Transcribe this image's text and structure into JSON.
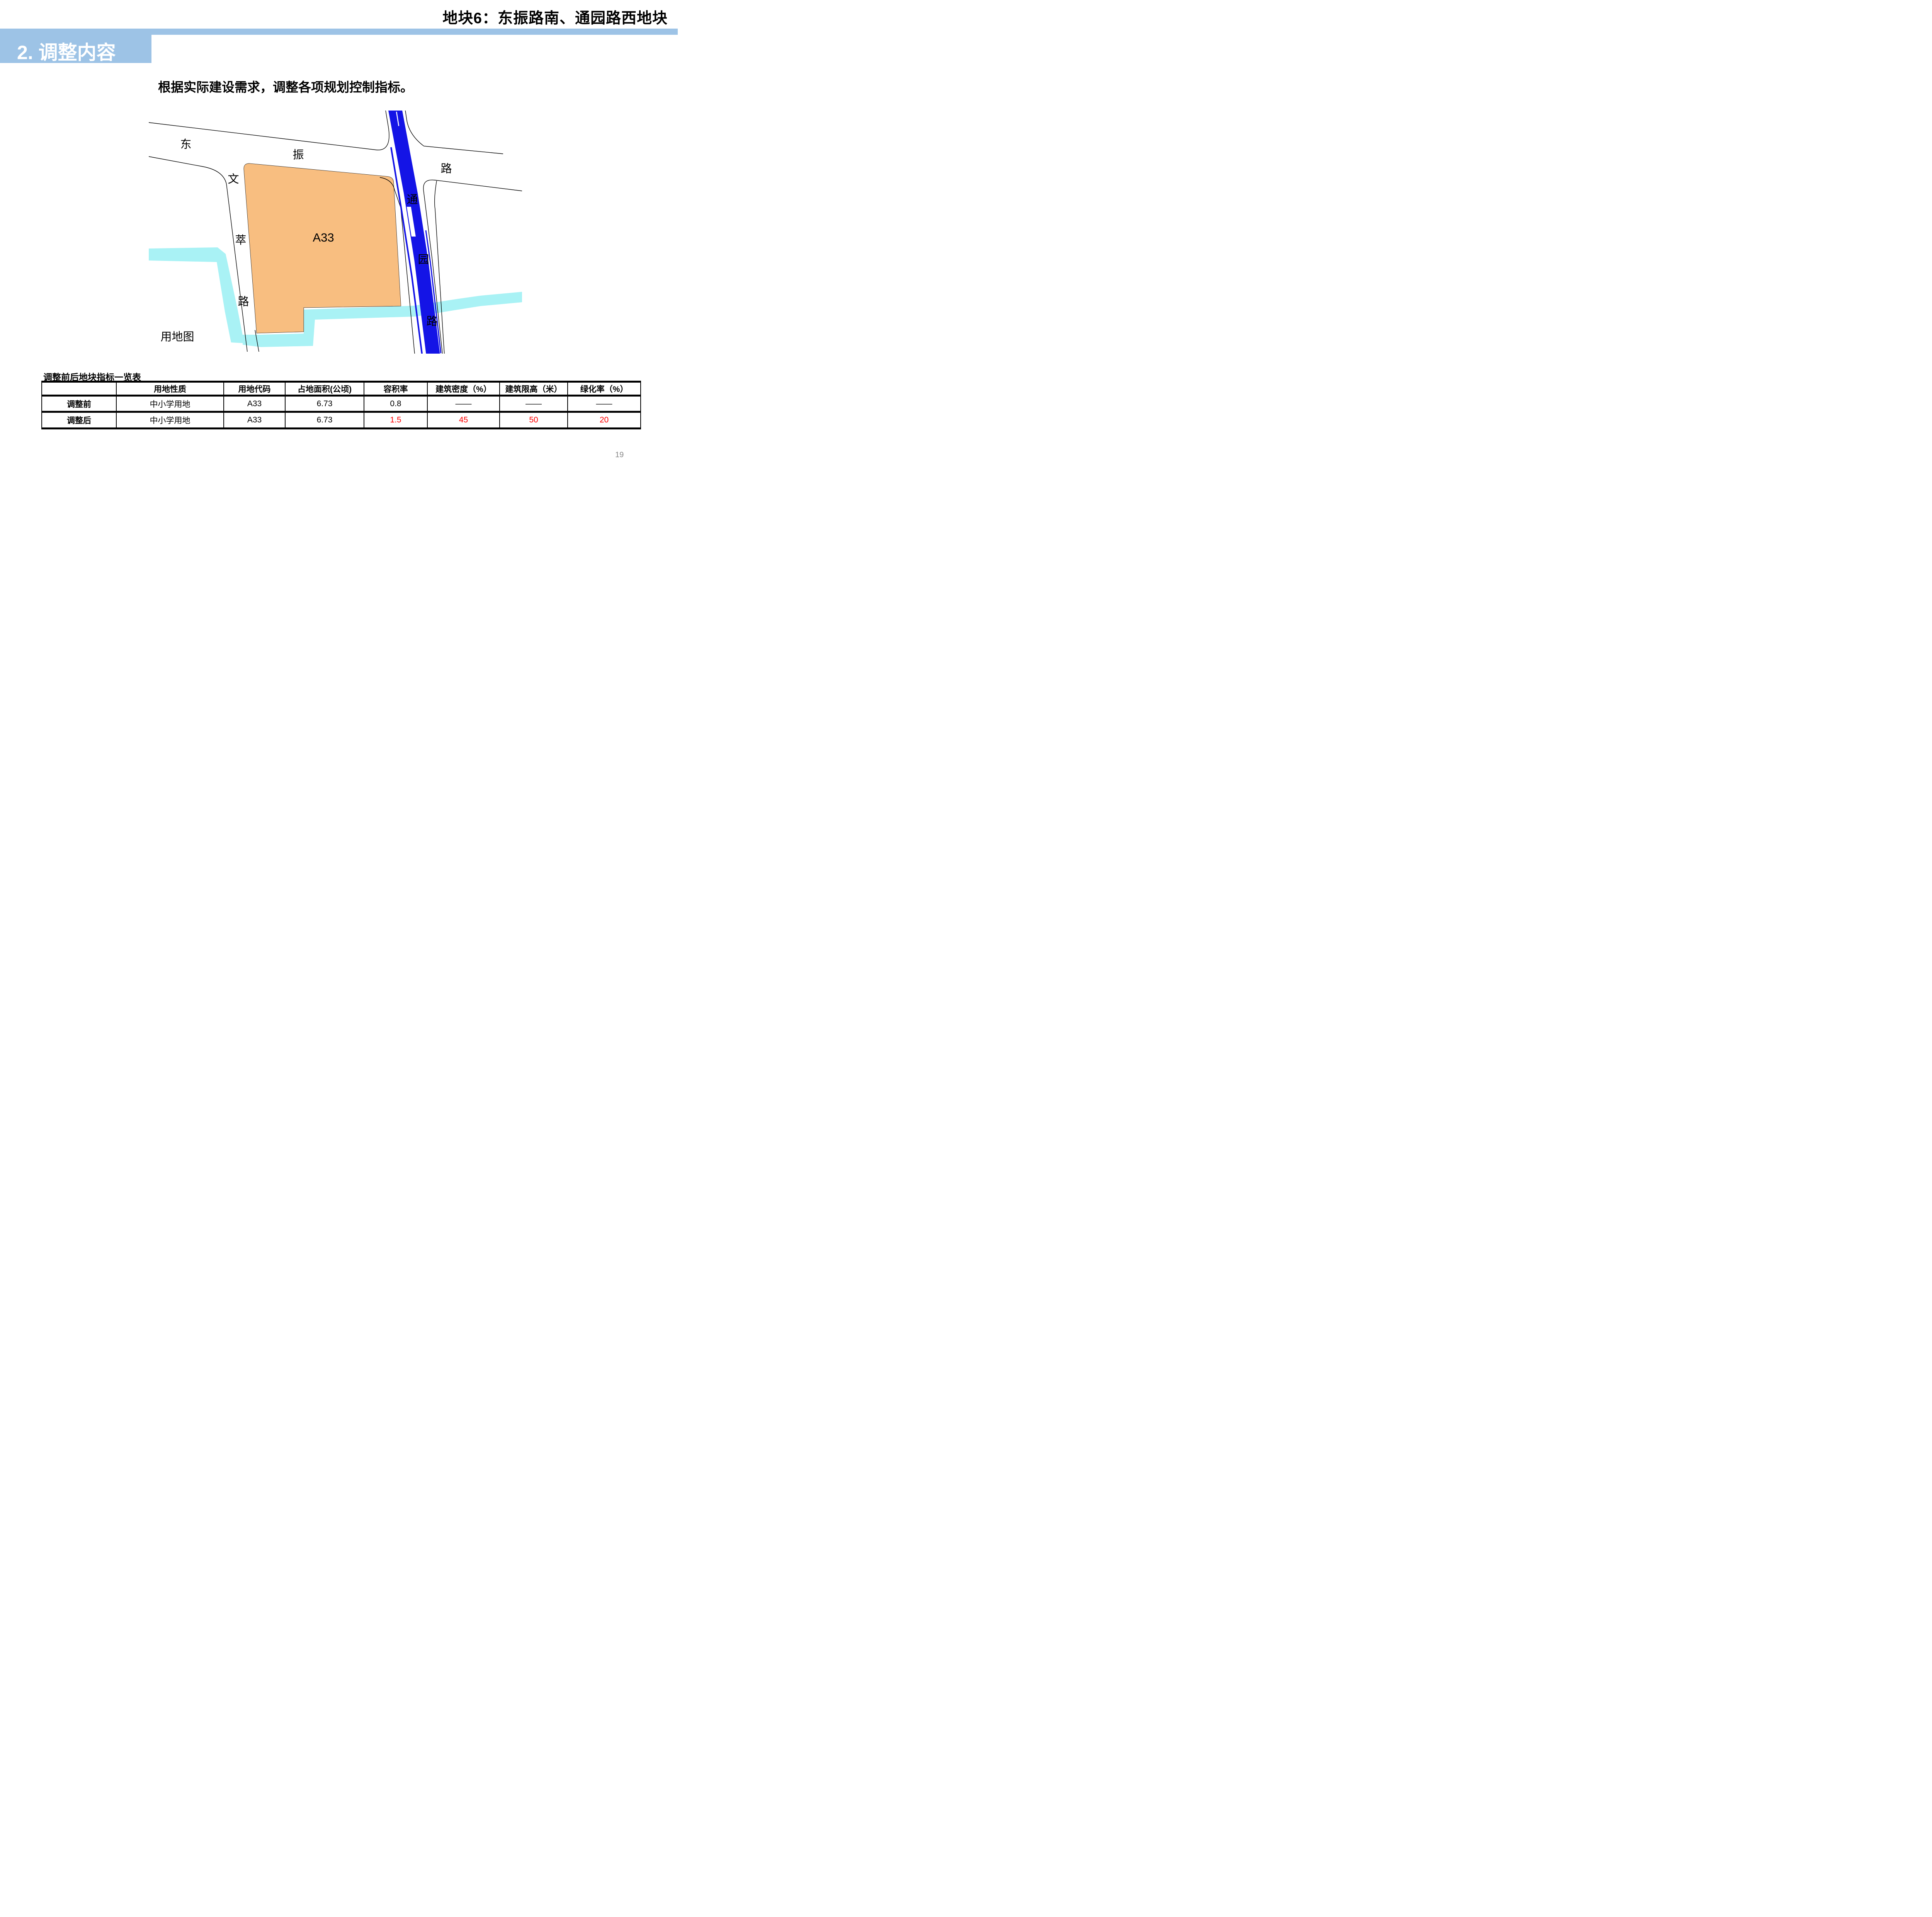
{
  "header": {
    "title": "地块6：东振路南、通园路西地块"
  },
  "section": {
    "label": "2. 调整内容"
  },
  "body": {
    "paragraph": "根据实际建设需求，调整各项规划控制指标。"
  },
  "map": {
    "caption": "用地图",
    "parcel_label": "A33",
    "road_dongzhen": [
      "东",
      "振",
      "路"
    ],
    "road_wencui": [
      "文",
      "萃",
      "路"
    ],
    "road_tongyuan": [
      "通",
      "园",
      "路"
    ],
    "colors": {
      "parcel_orange": "#F8BE80",
      "water_cyan": "#A9F2F5",
      "road_blue": "#1414E6",
      "road_outline": "#000000"
    }
  },
  "table": {
    "title": "调整前后地块指标一览表",
    "header": [
      "",
      "用地性质",
      "用地代码",
      "占地面积(公顷)",
      "容积率",
      "建筑密度（%）",
      "建筑限高（米）",
      "绿化率（%）"
    ],
    "rows": [
      {
        "cells": [
          "调整前",
          "中小学用地",
          "A33",
          "6.73",
          "0.8",
          "——",
          "——",
          "——"
        ]
      },
      {
        "cells": [
          "调整后",
          "中小学用地",
          "A33",
          "6.73",
          "1.5",
          "45",
          "50",
          "20"
        ]
      }
    ]
  },
  "theme": {
    "accent_blue": "#9DC3E6",
    "highlight_red": "#FF0000",
    "page_number_gray": "#8A8A8A"
  },
  "page": {
    "number": "19"
  }
}
